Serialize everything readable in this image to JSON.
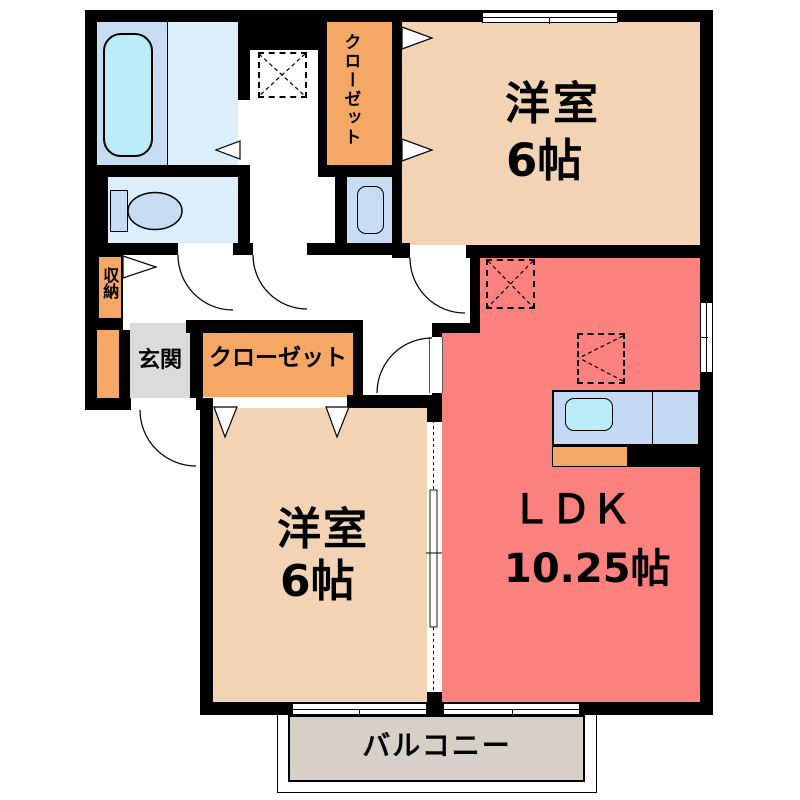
{
  "floor_plan": {
    "rooms": {
      "western_room_top": {
        "name": "洋室",
        "size": "6帖"
      },
      "western_room_bottom": {
        "name": "洋室",
        "size": "6帖"
      },
      "ldk": {
        "name": "ＬＤＫ",
        "size": "10.25帖"
      },
      "closet_top": {
        "name": "クローゼット"
      },
      "closet_bottom": {
        "name": "クローゼット"
      },
      "entrance": {
        "name": "玄関"
      },
      "storage": {
        "name": "収納"
      },
      "balcony": {
        "name": "バルコニー"
      }
    },
    "colors": {
      "wall": "#000000",
      "western_room": "#f2d3b4",
      "ldk": "#fa817e",
      "closet": "#f5a766",
      "entrance_floor": "#dbdbdb",
      "balcony_floor": "#d6d0c9",
      "bathroom_floor": "#c5dcf2",
      "toilet_floor": "#ddeefb",
      "water_fixture": "#b9ecf6",
      "kitchen_counter": "#c3d9f4"
    }
  }
}
